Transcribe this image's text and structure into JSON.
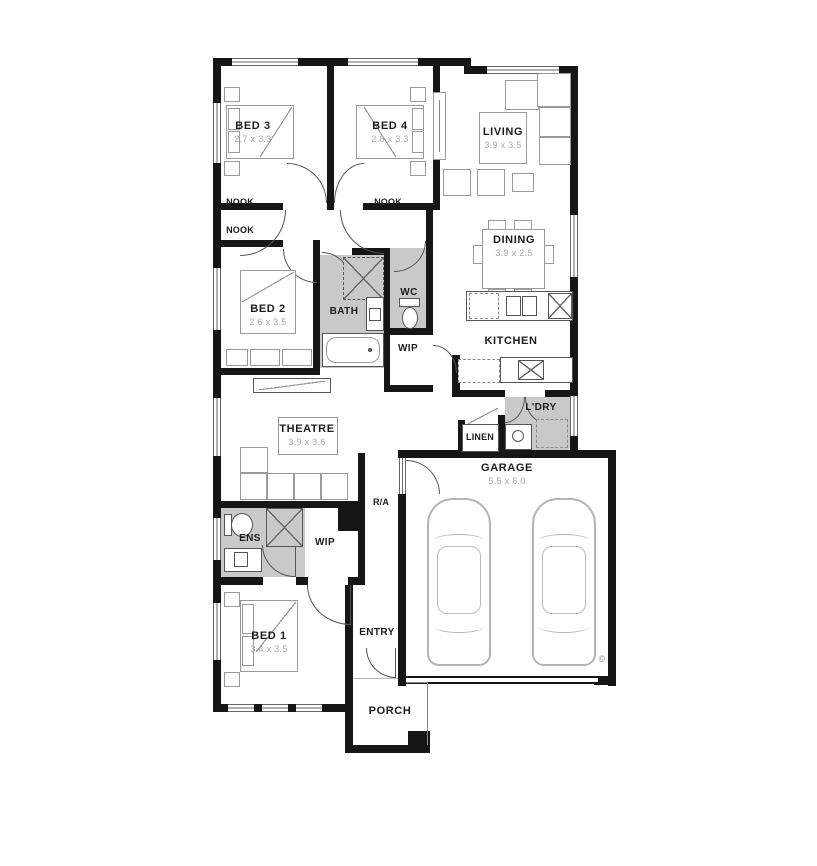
{
  "plan": {
    "title": "single-storey house floor plan",
    "rooms": {
      "bed3": {
        "name": "BED 3",
        "dims": "2.7 x 3.3"
      },
      "bed4": {
        "name": "BED 4",
        "dims": "2.8 x 3.3"
      },
      "living": {
        "name": "LIVING",
        "dims": "3.9 x 3.5"
      },
      "dining": {
        "name": "DINING",
        "dims": "3.9 x 2.5"
      },
      "bed2": {
        "name": "BED 2",
        "dims": "2.6 x 3.5"
      },
      "bath": {
        "name": "BATH"
      },
      "wc": {
        "name": "WC"
      },
      "wip_pantry": {
        "name": "WIP"
      },
      "kitchen": {
        "name": "KITCHEN"
      },
      "theatre": {
        "name": "THEATRE",
        "dims": "3.9 x 3.6"
      },
      "laundry": {
        "name": "L'DRY"
      },
      "linen": {
        "name": "LINEN"
      },
      "garage": {
        "name": "GARAGE",
        "dims": "5.5 x 6.0"
      },
      "ens": {
        "name": "ENS"
      },
      "wip_robe": {
        "name": "WIP"
      },
      "return_air": {
        "name": "R/A"
      },
      "bed1": {
        "name": "BED 1",
        "dims": "3.4 x 3.5"
      },
      "entry": {
        "name": "ENTRY"
      },
      "porch": {
        "name": "PORCH"
      },
      "nook_bed3": {
        "name": "NOOK"
      },
      "nook_bed2": {
        "name": "NOOK"
      },
      "nook_bed4": {
        "name": "NOOK"
      }
    },
    "copyright": "©",
    "colors": {
      "wall": "#161616",
      "wet_area": "#c9c9c9",
      "furniture_line": "#9a9a9a",
      "dim_text": "#a8a8a8"
    }
  }
}
